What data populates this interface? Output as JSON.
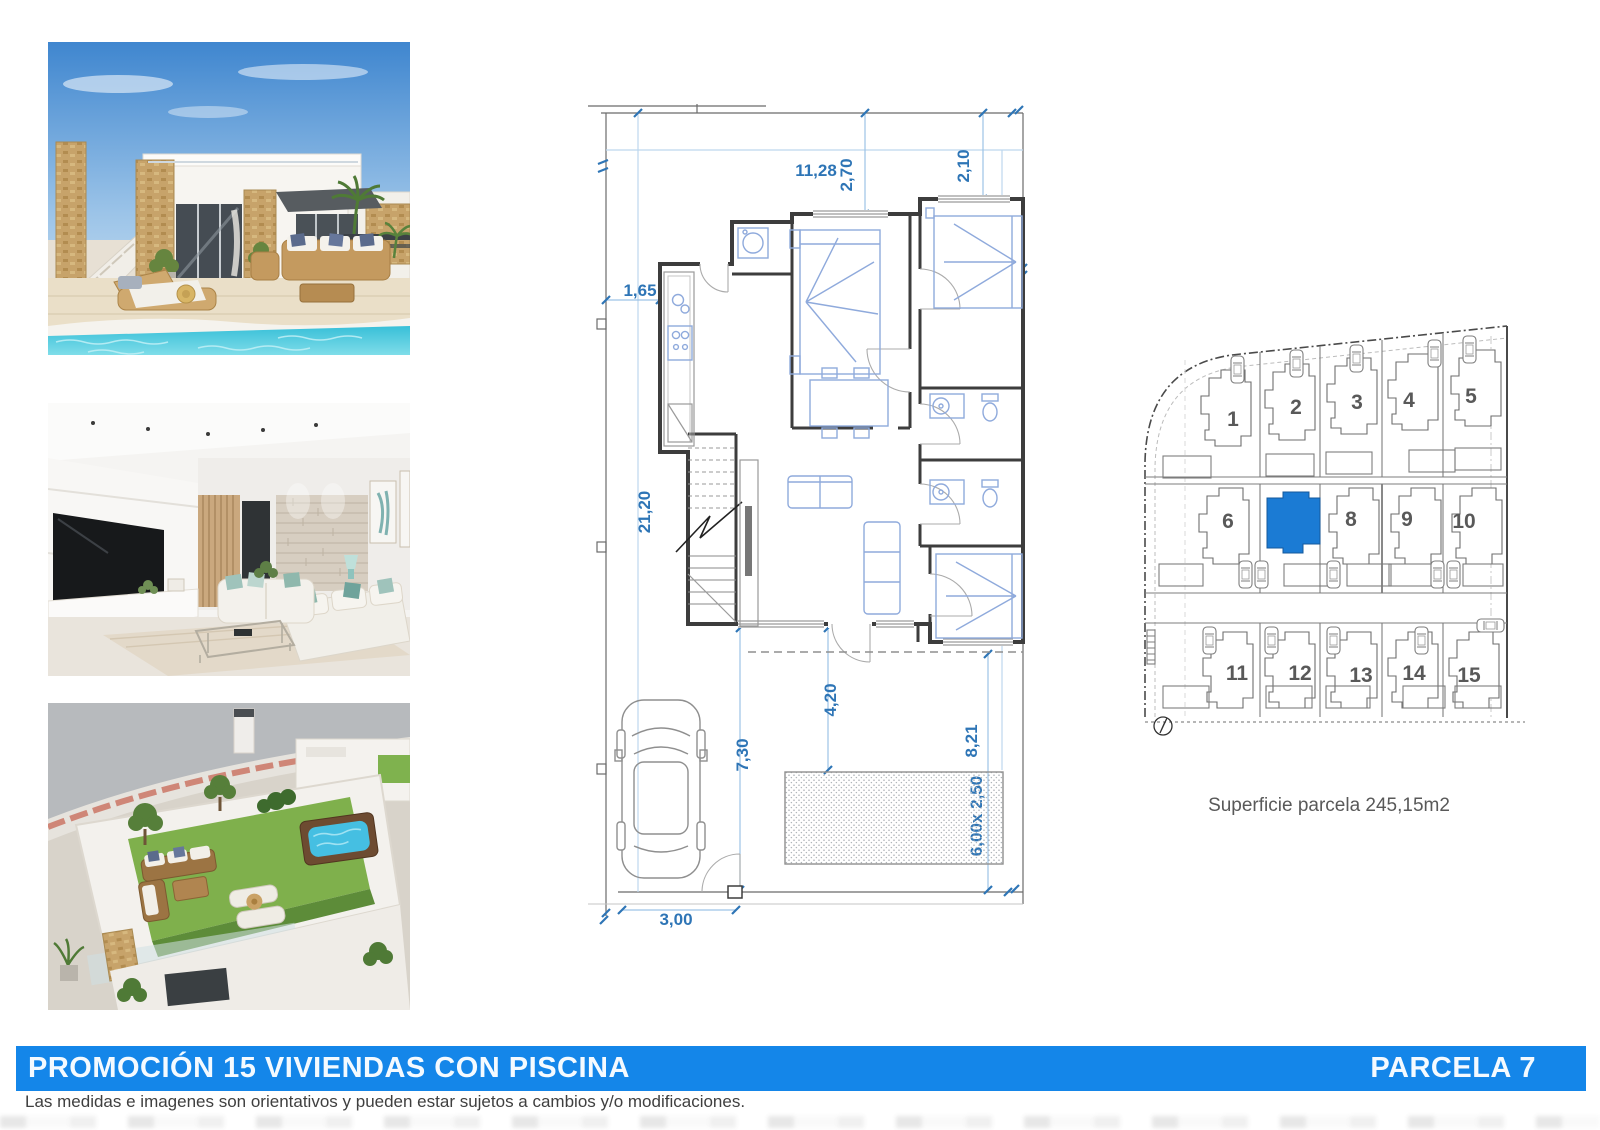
{
  "photos": {
    "exterior_alt": "Modern villa exterior with private pool and terrace",
    "interior_alt": "Open plan living room interior",
    "rooftop_alt": "Rooftop solarium with lawn and jacuzzi"
  },
  "floor_plan": {
    "dimensions": {
      "width_top": "11,28",
      "offset_top_mid": "2,70",
      "offset_top_right": "2,10",
      "offset_left_top": "1,65",
      "depth_left": "21,20",
      "front_left": "7,30",
      "front_mid": "4,20",
      "front_right": "8,21",
      "pool_size": "6,00x 2,50",
      "gate_width": "3,00"
    },
    "dimension_color": "#2e75b6"
  },
  "site_plan": {
    "parcels": [
      {
        "label": "1",
        "highlighted": false
      },
      {
        "label": "2",
        "highlighted": false
      },
      {
        "label": "3",
        "highlighted": false
      },
      {
        "label": "4",
        "highlighted": false
      },
      {
        "label": "5",
        "highlighted": false
      },
      {
        "label": "6",
        "highlighted": false
      },
      {
        "label": "",
        "highlighted": true
      },
      {
        "label": "8",
        "highlighted": false
      },
      {
        "label": "9",
        "highlighted": false
      },
      {
        "label": "10",
        "highlighted": false
      },
      {
        "label": "11",
        "highlighted": false
      },
      {
        "label": "12",
        "highlighted": false
      },
      {
        "label": "13",
        "highlighted": false
      },
      {
        "label": "14",
        "highlighted": false
      },
      {
        "label": "15",
        "highlighted": false
      }
    ],
    "highlight_color": "#1b7bd4",
    "caption": "Superficie parcela 245,15m2"
  },
  "footer": {
    "title": "PROMOCIÓN 15 VIVIENDAS CON PISCINA",
    "parcel": "PARCELA 7",
    "banner_color": "#1486e9"
  },
  "disclaimer": "Las medidas e imagenes son orientativos y pueden estar sujetos a cambios y/o modificaciones."
}
